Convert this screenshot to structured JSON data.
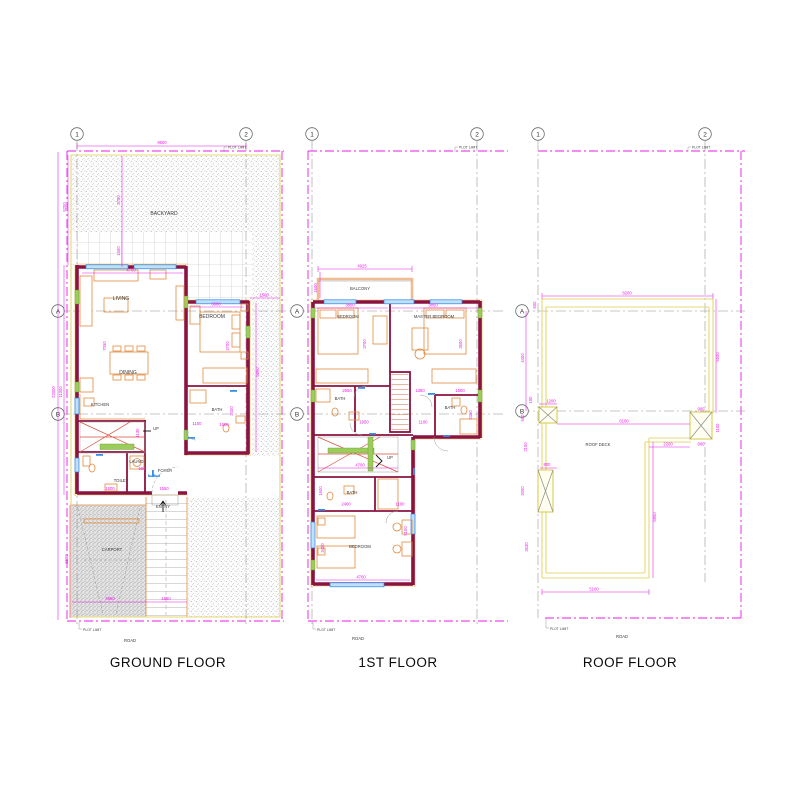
{
  "titles": {
    "ground": "GROUND FLOOR",
    "first": "1ST FLOOR",
    "roof": "ROOF FLOOR"
  },
  "grid": {
    "col1": "1",
    "col2": "2",
    "rowA": "A",
    "rowB": "B"
  },
  "common": {
    "road": "ROAD",
    "plot_limit": "PLOT LIMIT",
    "up": "UP"
  },
  "ground": {
    "labels": {
      "backyard": "BACKYARD",
      "living": "LIVING",
      "bedroom": "BEDROOM",
      "dining": "DINING",
      "kitchen": "KITCHEN",
      "bath": "BATH",
      "toilet": "TOILET",
      "laundry": "LAUND.",
      "foyer": "FOYER",
      "entry": "ENTRY",
      "carport": "CARPORT"
    },
    "dims": {
      "plot_w": "9500",
      "backyard_h": "5200",
      "yard_a": "3700",
      "yard_b": "1500",
      "living_w": "4700",
      "living_h": "7050",
      "bedroom_w": "3600",
      "bedroom_h": "3700",
      "side_off": "1500",
      "side_h": "6860",
      "plot_h": "22000",
      "house_h": "11300",
      "bath_h": "2400",
      "bath_w": "1600",
      "open_a": "1100",
      "stair_w": "1130",
      "laund_w": "660",
      "toilet_w": "1600",
      "foyer_w": "1550",
      "carport_h": "5550",
      "carport_w": "4950",
      "walk_w": "1850"
    }
  },
  "first": {
    "labels": {
      "balcony": "BALCONY",
      "bedroom": "BEDROOM",
      "master": "MASTER BEDROOM",
      "bath": "BATH",
      "bedroom2": "BEDROOM"
    },
    "dims": {
      "balcony_w": "4925",
      "balcony_h": "1600",
      "bed_w": "3850",
      "master_w": "3850",
      "bed_h": "3700",
      "master_h": "3500",
      "bath1_w": "2650",
      "hall_a": "1350",
      "bath2_w": "1800",
      "hall_b": "1950",
      "open_a": "1100",
      "bath2_h": "2450",
      "stair_w": "4700",
      "bath3_h": "1600",
      "bath3_w": "2400",
      "open_b": "1100",
      "wing_h": "5100",
      "bed2_h": "3400",
      "bed2_w": "4700"
    }
  },
  "roof": {
    "labels": {
      "deck": "ROOF DECK"
    },
    "dims": {
      "deck_w": "8200",
      "band": "600",
      "left_a": "4400",
      "right_a": "5500",
      "t150": "150",
      "col_a": "1200",
      "t600": "600",
      "span": "6100",
      "col_b": "900",
      "col_c": "1100",
      "ledge": "2200",
      "col_d": "900",
      "left_b": "2150",
      "col_e": "800",
      "left_c": "2000",
      "left_d": "3530",
      "right_b": "6950",
      "deck_b": "5100"
    }
  }
}
